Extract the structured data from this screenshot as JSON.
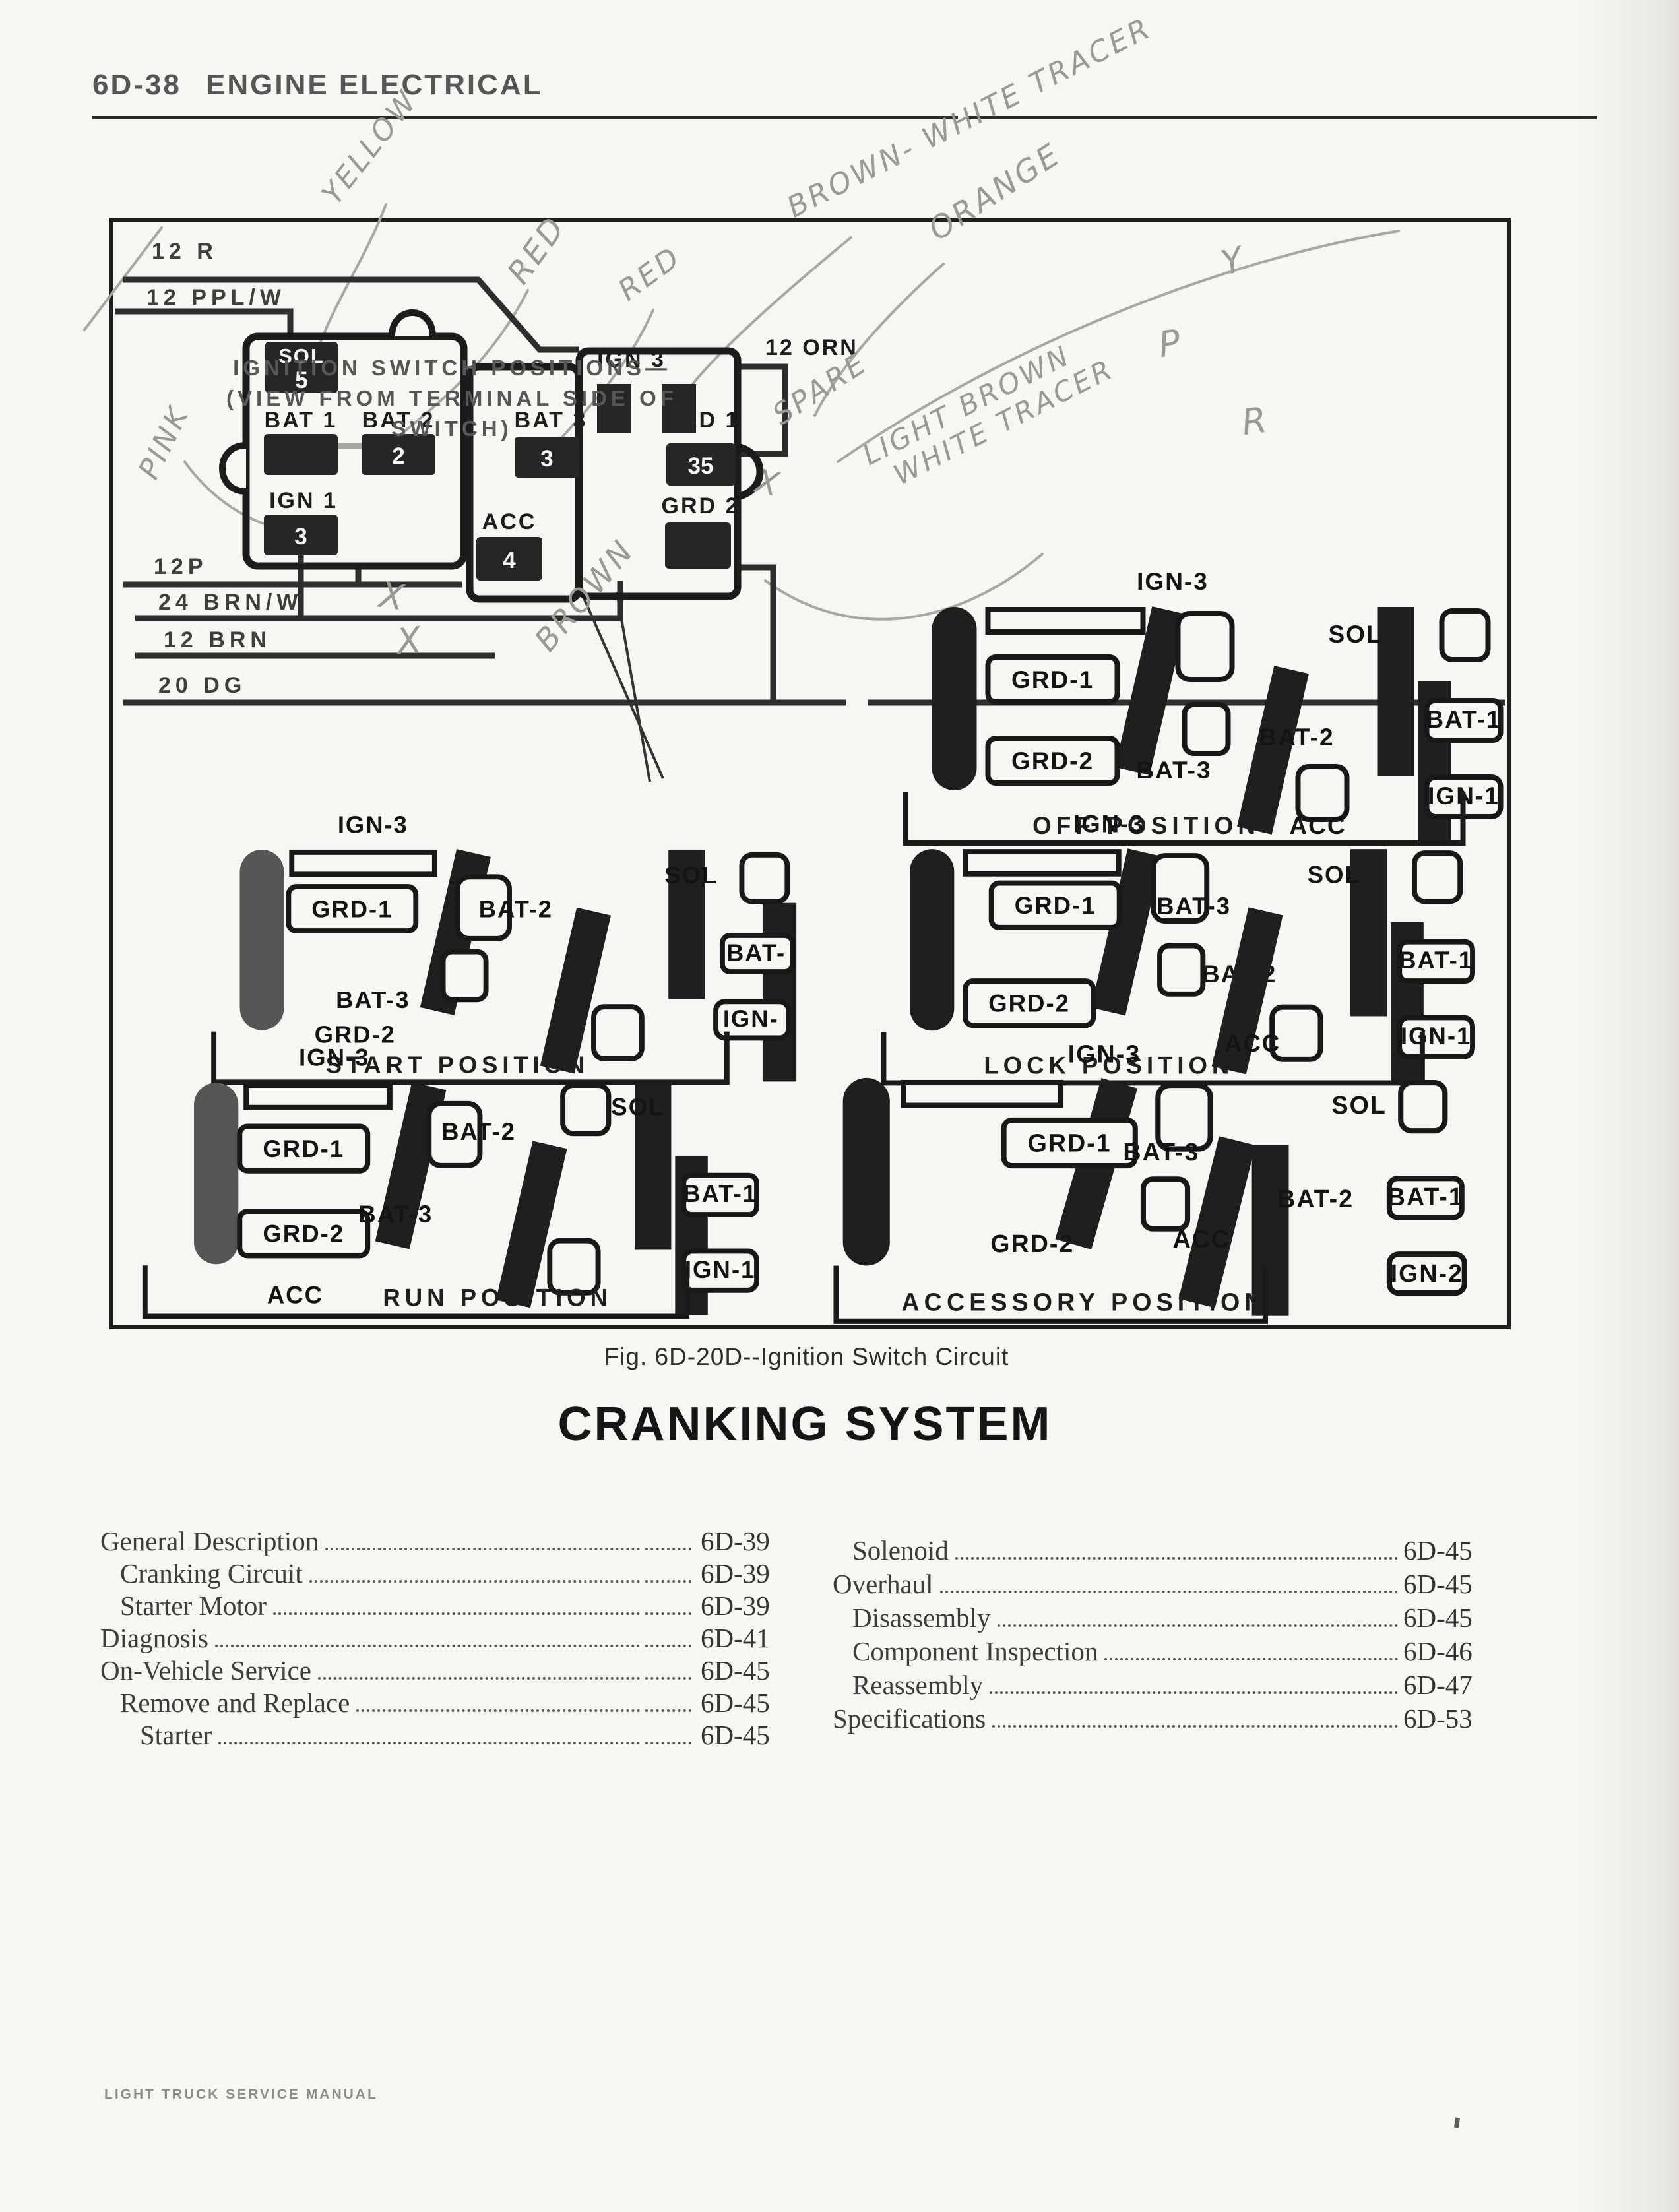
{
  "header": {
    "code": "6D-38",
    "title": "ENGINE ELECTRICAL"
  },
  "figure": {
    "caption": "Fig. 6D-20D--Ignition Switch Circuit",
    "note1": "IGNITION SWITCH POSITIONS—",
    "note2": "(VIEW FROM TERMINAL SIDE OF SWITCH)",
    "wires": {
      "w12r": "12 R",
      "w12pplw": "12 PPL/W",
      "w12p": "12P",
      "w24brnw": "24 BRN/W",
      "w12brn": "12 BRN",
      "w20dg": "20 DG",
      "w12orn": "12 ORN"
    },
    "connector": {
      "sol": "SOL",
      "sol_num": "5",
      "bat1": "BAT 1",
      "bat2": "BAT 2",
      "bat2_num": "2",
      "bat3": "BAT 3",
      "bat3_num": "3",
      "ign1": "IGN 1",
      "ign1_num": "3",
      "acc": "ACC",
      "acc_num": "4",
      "ign3": "IGN 3",
      "grd1": "GRD 1",
      "grd1_num": "35",
      "grd2": "GRD 2"
    },
    "handwriting": {
      "yellow": "YELLOW",
      "red1": "RED",
      "red2": "RED",
      "brown_white": "BROWN- WHITE TRACER",
      "orange": "ORANGE",
      "y": "Y",
      "p": "P",
      "r": "R",
      "pink": "PINK",
      "spare": "SPARE",
      "light_brown": "LIGHT BROWN",
      "white_tracer": "WHITE TRACER",
      "brown": "BROWN",
      "x1": "X",
      "x2": "X",
      "x3": "X"
    },
    "positions": [
      {
        "ign3": "IGN-3",
        "grd1": "GRD-1",
        "grd2": "GRD-2",
        "bat3": "BAT-3",
        "bat2": "BAT-2",
        "bat1": "BAT-1",
        "ign_right": "IGN-1",
        "sol": "SOL",
        "acc": "ACC",
        "name": "OFF POSITION"
      },
      {
        "ign3": "IGN-3",
        "grd1": "GRD-1",
        "grd2": "GRD-2",
        "bat3": "BAT-3",
        "bat2": "BAT-2",
        "bat1": "BAT-",
        "ign_right": "IGN-",
        "sol": "SOL",
        "acc": "",
        "name": "START POSITION"
      },
      {
        "ign3": "IGN-3",
        "grd1": "GRD-1",
        "grd2": "GRD-2",
        "bat3": "BAT-3",
        "bat2": "BAT-2",
        "bat1": "BAT-1",
        "ign_right": "IGN-1",
        "sol": "SOL",
        "acc": "ACC",
        "name": "LOCK POSITION"
      },
      {
        "ign3": "IGN-3",
        "grd1": "GRD-1",
        "grd2": "GRD-2",
        "bat3": "BAT-3",
        "bat2": "BAT-2",
        "bat1": "BAT-1",
        "ign_right": "IGN-1",
        "sol": "SOL",
        "acc": "ACC",
        "name": "RUN POSITION"
      },
      {
        "ign3": "IGN-3",
        "grd1": "GRD-1",
        "grd2": "GRD-2",
        "bat3": "BAT-3",
        "bat2": "BAT-2",
        "bat1": "BAT-1",
        "ign_right": "IGN-2",
        "sol": "SOL",
        "acc": "ACC",
        "name": "ACCESSORY POSITION"
      }
    ]
  },
  "section_title": "CRANKING SYSTEM",
  "toc": {
    "left": [
      {
        "label": "General Description",
        "page": "6D-39",
        "indent": 0
      },
      {
        "label": "Cranking Circuit",
        "page": "6D-39",
        "indent": 1
      },
      {
        "label": "Starter Motor",
        "page": "6D-39",
        "indent": 1
      },
      {
        "label": "Diagnosis",
        "page": "6D-41",
        "indent": 0
      },
      {
        "label": "On-Vehicle Service",
        "page": "6D-45",
        "indent": 0
      },
      {
        "label": "Remove and Replace",
        "page": "6D-45",
        "indent": 1
      },
      {
        "label": "Starter",
        "page": "6D-45",
        "indent": 2
      }
    ],
    "right": [
      {
        "label": "Solenoid",
        "page": "6D-45",
        "indent": 1
      },
      {
        "label": "Overhaul",
        "page": "6D-45",
        "indent": 0
      },
      {
        "label": "Disassembly",
        "page": "6D-45",
        "indent": 1
      },
      {
        "label": "Component Inspection",
        "page": "6D-46",
        "indent": 1
      },
      {
        "label": "Reassembly",
        "page": "6D-47",
        "indent": 1
      },
      {
        "label": "Specifications",
        "page": "6D-53",
        "indent": 0
      }
    ]
  },
  "footer": "LIGHT TRUCK SERVICE MANUAL"
}
